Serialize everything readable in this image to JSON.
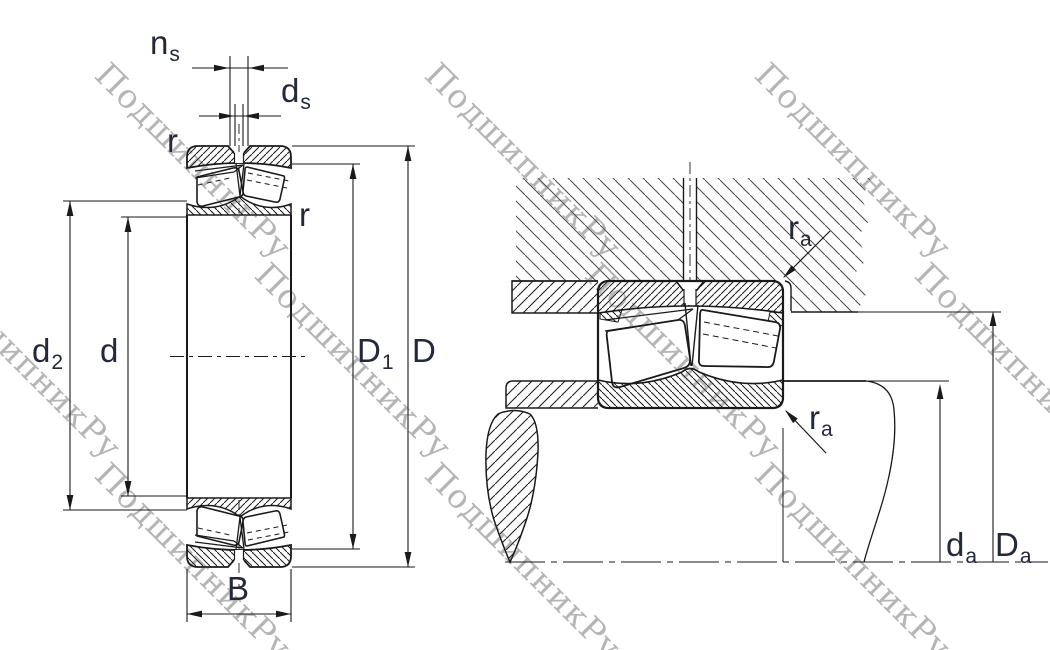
{
  "watermark": {
    "text": "ПодшипникРу",
    "color": "#b5b5b5"
  },
  "left_view": {
    "title": "bearing cross-section with boundary dimensions",
    "labels": {
      "ns": {
        "base": "n",
        "sub": "s"
      },
      "ds": {
        "base": "d",
        "sub": "s"
      },
      "r_top": {
        "base": "r",
        "sub": ""
      },
      "r_side": {
        "base": "r",
        "sub": ""
      },
      "d2": {
        "base": "d",
        "sub": "2"
      },
      "d": {
        "base": "d",
        "sub": ""
      },
      "D1": {
        "base": "D",
        "sub": "1"
      },
      "D": {
        "base": "D",
        "sub": ""
      },
      "B": {
        "base": "B",
        "sub": ""
      }
    }
  },
  "right_view": {
    "title": "mounting and abutment dimensions",
    "labels": {
      "ra_housing": {
        "base": "r",
        "sub": "a"
      },
      "ra_shaft": {
        "base": "r",
        "sub": "a"
      },
      "da": {
        "base": "d",
        "sub": "a"
      },
      "Da": {
        "base": "D",
        "sub": "a"
      }
    }
  },
  "colors": {
    "line": "#1a1a1a",
    "label": "#23283a",
    "hatch_thin": "#474747",
    "watermark": "#b5b5b5"
  }
}
